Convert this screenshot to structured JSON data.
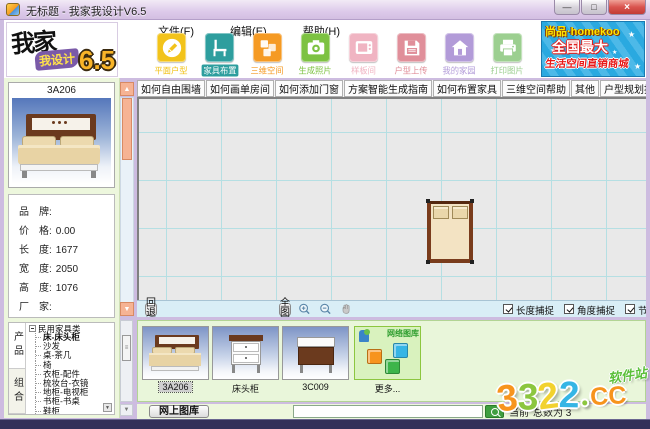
{
  "window": {
    "title": "无标题 - 我家我设计V6.5",
    "buttons": [
      {
        "name": "minimize",
        "glyph": "—"
      },
      {
        "name": "maximize",
        "glyph": "□"
      },
      {
        "name": "close",
        "glyph": "×"
      }
    ]
  },
  "logo": {
    "line1": "我家",
    "line2": "我设计",
    "version": "6.5"
  },
  "menu": {
    "items": [
      "文件(F)",
      "编辑(E)",
      "帮助(H)"
    ]
  },
  "toolbar": {
    "items": [
      {
        "label": "平面户型",
        "color": "#f2c31b",
        "icon": "pencil-icon",
        "selected": false
      },
      {
        "label": "家具布置",
        "color": "#2e9e9e",
        "icon": "chair-icon",
        "selected": true
      },
      {
        "label": "三维空间",
        "color": "#f59a23",
        "icon": "cubes-icon",
        "selected": false
      },
      {
        "label": "生成照片",
        "color": "#7dc242",
        "icon": "camera-icon",
        "selected": false
      },
      {
        "label": "样板间",
        "color": "#f0b4c2",
        "icon": "tv-icon",
        "selected": false
      },
      {
        "label": "户型上传",
        "color": "#e08f9a",
        "icon": "floppy-icon",
        "selected": false
      },
      {
        "label": "我的家园",
        "color": "#b29bd8",
        "icon": "house-icon",
        "selected": false
      },
      {
        "label": "打印图片",
        "color": "#9ccf90",
        "icon": "printer-icon",
        "selected": false
      }
    ]
  },
  "banner": {
    "brand": "尚品·homekoo",
    "line2": "全国最大",
    "line3": "生活空间直销商城"
  },
  "help_strip": {
    "items": [
      {
        "label": "如何自由围墙",
        "accent": false
      },
      {
        "label": "如何画单房间",
        "accent": false
      },
      {
        "label": "如何添加门窗",
        "accent": false
      },
      {
        "label": "方案智能生成指南",
        "accent": false
      },
      {
        "label": "如何布置家具",
        "accent": false
      },
      {
        "label": "三维空间帮助",
        "accent": false
      },
      {
        "label": "其他",
        "accent": false
      },
      {
        "label": "户型规划指南",
        "accent": false
      },
      {
        "label": "空间布置帮助",
        "accent": false
      },
      {
        "label": "特惠空间直销",
        "accent": true
      }
    ]
  },
  "product_panel": {
    "title": "3A206",
    "info": [
      {
        "label": "品　牌:",
        "value": ""
      },
      {
        "label": "价　格:",
        "value": "0.00"
      },
      {
        "label": "长　度:",
        "value": "1677"
      },
      {
        "label": "宽　度:",
        "value": "2050"
      },
      {
        "label": "高　度:",
        "value": "1076"
      },
      {
        "label": "厂　家:",
        "value": ""
      }
    ]
  },
  "category_tree": {
    "tabs": [
      {
        "label": "产品",
        "active": true
      },
      {
        "label": "组合",
        "active": false
      }
    ],
    "root": "民用家具类",
    "items": [
      {
        "label": "床-床头柜",
        "selected": true
      },
      {
        "label": "沙发",
        "selected": false
      },
      {
        "label": "桌-茶几",
        "selected": false
      },
      {
        "label": "椅",
        "selected": false
      },
      {
        "label": "衣柜-配件",
        "selected": false
      },
      {
        "label": "梳妆台-衣镜",
        "selected": false
      },
      {
        "label": "地柜-电视柜",
        "selected": false
      },
      {
        "label": "书柜-书桌",
        "selected": false
      },
      {
        "label": "鞋柜",
        "selected": false
      }
    ]
  },
  "canvas": {
    "back_label": "回退",
    "fit_label": "全图",
    "snaps": [
      "长度捕捉",
      "角度捕捉",
      "节点捕捉"
    ]
  },
  "thumbnails": {
    "cards": [
      {
        "label": "3A206",
        "type": "bed",
        "selected": true
      },
      {
        "label": "床头柜",
        "type": "nightstand",
        "selected": false
      },
      {
        "label": "3C009",
        "type": "nightstand2",
        "selected": false
      },
      {
        "label": "更多...",
        "type": "more",
        "selected": false,
        "overlay": "网络图库"
      }
    ]
  },
  "bottom_bar": {
    "online_button": "网上图库",
    "search_value": "",
    "status_left": "当前",
    "status_right": "总数为 3"
  },
  "watermark": {
    "letters": [
      {
        "ch": "3",
        "color": "#f7941d"
      },
      {
        "ch": "3",
        "color": "#8cc63f"
      },
      {
        "ch": "2",
        "color": "#f2d22e"
      },
      {
        "ch": "2",
        "color": "#35b5e5"
      }
    ],
    "dot_color": "#8cc63f",
    "suffix": "CC",
    "suffix_color": "#f7941d",
    "site": "软件站",
    "site_color": "#5bbf3a"
  }
}
